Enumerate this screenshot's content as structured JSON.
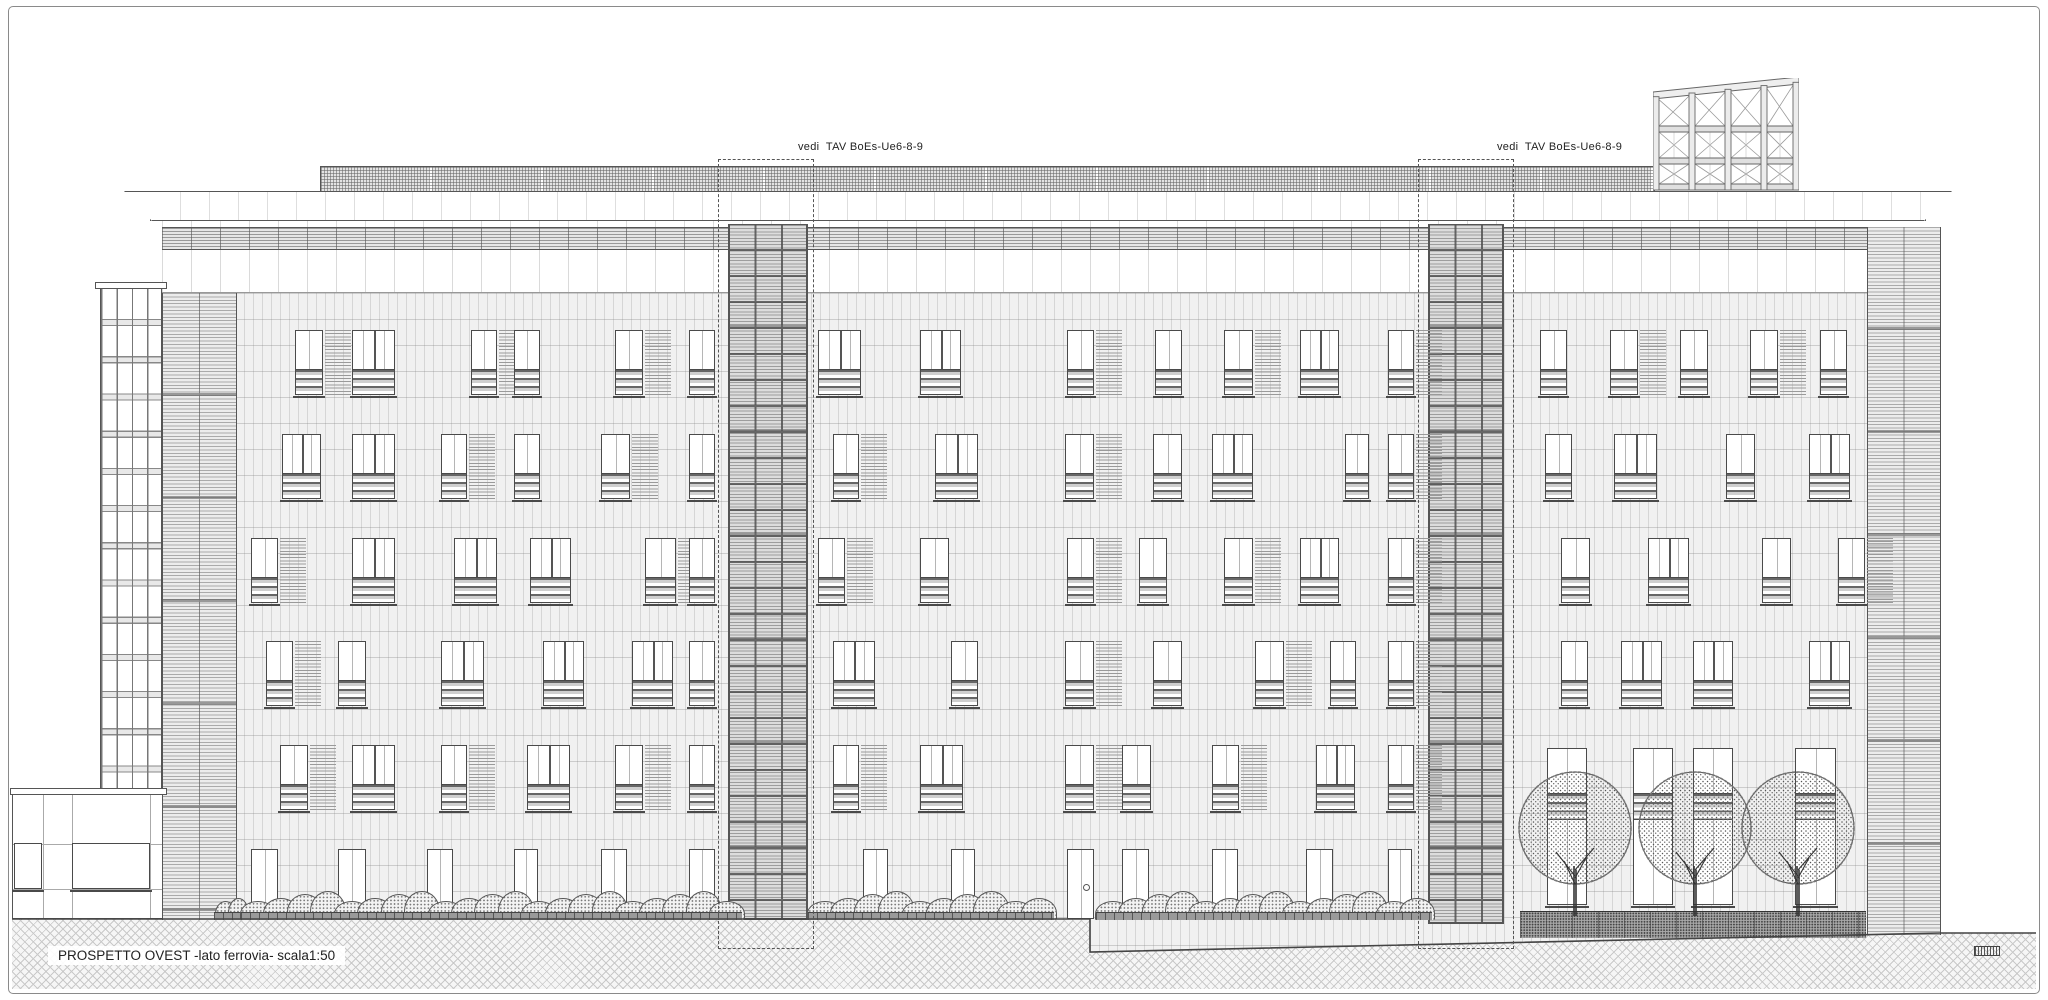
{
  "title": "PROSPETTO OVEST -lato ferrovia- scala1:50",
  "annotations": {
    "detail_ref_left": "vedi  TAV BoEs-Ue6-8-9",
    "detail_ref_right": "vedi  TAV BoEs-Ue6-8-9"
  },
  "colors": {
    "paper": "#ffffff",
    "ink": "#4a4a4a",
    "light_line": "#999999",
    "texture": "#ececec"
  },
  "elevation": {
    "window_rows": [
      {
        "y": 330,
        "h": 65,
        "kind": "std",
        "items": [
          {
            "x": 295,
            "w": 28
          },
          {
            "x": 352,
            "w": 43
          },
          {
            "x": 471,
            "w": 26
          },
          {
            "x": 514,
            "w": 26
          },
          {
            "x": 615,
            "w": 28
          },
          {
            "x": 689,
            "w": 26
          },
          {
            "x": 818,
            "w": 43
          },
          {
            "x": 920,
            "w": 41
          },
          {
            "x": 1067,
            "w": 27
          },
          {
            "x": 1155,
            "w": 27
          },
          {
            "x": 1224,
            "w": 29
          },
          {
            "x": 1300,
            "w": 39
          },
          {
            "x": 1388,
            "w": 26
          },
          {
            "x": 1540,
            "w": 27
          },
          {
            "x": 1610,
            "w": 28
          },
          {
            "x": 1680,
            "w": 28
          },
          {
            "x": 1750,
            "w": 28
          },
          {
            "x": 1820,
            "w": 27
          }
        ]
      },
      {
        "y": 434,
        "h": 65,
        "kind": "std",
        "items": [
          {
            "x": 282,
            "w": 39
          },
          {
            "x": 352,
            "w": 43
          },
          {
            "x": 441,
            "w": 26
          },
          {
            "x": 514,
            "w": 26
          },
          {
            "x": 601,
            "w": 29
          },
          {
            "x": 689,
            "w": 26
          },
          {
            "x": 833,
            "w": 26
          },
          {
            "x": 935,
            "w": 43
          },
          {
            "x": 1065,
            "w": 29
          },
          {
            "x": 1153,
            "w": 29
          },
          {
            "x": 1212,
            "w": 41
          },
          {
            "x": 1345,
            "w": 24
          },
          {
            "x": 1388,
            "w": 26
          },
          {
            "x": 1545,
            "w": 27
          },
          {
            "x": 1614,
            "w": 43
          },
          {
            "x": 1726,
            "w": 29
          },
          {
            "x": 1809,
            "w": 41
          }
        ]
      },
      {
        "y": 538,
        "h": 65,
        "kind": "std",
        "items": [
          {
            "x": 251,
            "w": 27
          },
          {
            "x": 352,
            "w": 43
          },
          {
            "x": 454,
            "w": 43
          },
          {
            "x": 530,
            "w": 41
          },
          {
            "x": 645,
            "w": 31
          },
          {
            "x": 689,
            "w": 26
          },
          {
            "x": 818,
            "w": 27
          },
          {
            "x": 920,
            "w": 29
          },
          {
            "x": 1067,
            "w": 27
          },
          {
            "x": 1139,
            "w": 28
          },
          {
            "x": 1224,
            "w": 29
          },
          {
            "x": 1300,
            "w": 39
          },
          {
            "x": 1388,
            "w": 26
          },
          {
            "x": 1561,
            "w": 29
          },
          {
            "x": 1648,
            "w": 41
          },
          {
            "x": 1762,
            "w": 29
          },
          {
            "x": 1838,
            "w": 27
          }
        ]
      },
      {
        "y": 641,
        "h": 65,
        "kind": "std",
        "items": [
          {
            "x": 266,
            "w": 27
          },
          {
            "x": 338,
            "w": 28
          },
          {
            "x": 441,
            "w": 43
          },
          {
            "x": 543,
            "w": 41
          },
          {
            "x": 632,
            "w": 41
          },
          {
            "x": 689,
            "w": 26
          },
          {
            "x": 833,
            "w": 42
          },
          {
            "x": 951,
            "w": 27
          },
          {
            "x": 1065,
            "w": 29
          },
          {
            "x": 1153,
            "w": 29
          },
          {
            "x": 1255,
            "w": 29
          },
          {
            "x": 1330,
            "w": 26
          },
          {
            "x": 1388,
            "w": 26
          },
          {
            "x": 1561,
            "w": 27
          },
          {
            "x": 1621,
            "w": 41
          },
          {
            "x": 1693,
            "w": 40
          },
          {
            "x": 1809,
            "w": 41
          }
        ]
      },
      {
        "y": 745,
        "h": 65,
        "kind": "std",
        "items": [
          {
            "x": 280,
            "w": 28
          },
          {
            "x": 352,
            "w": 43
          },
          {
            "x": 441,
            "w": 26
          },
          {
            "x": 527,
            "w": 43
          },
          {
            "x": 615,
            "w": 28
          },
          {
            "x": 689,
            "w": 26
          },
          {
            "x": 833,
            "w": 26
          },
          {
            "x": 920,
            "w": 43
          },
          {
            "x": 1065,
            "w": 29
          },
          {
            "x": 1122,
            "w": 29
          },
          {
            "x": 1212,
            "w": 27
          },
          {
            "x": 1316,
            "w": 39
          },
          {
            "x": 1388,
            "w": 26
          }
        ]
      },
      {
        "y": 849,
        "h": 70,
        "kind": "door",
        "items": [
          {
            "x": 251,
            "w": 27
          },
          {
            "x": 338,
            "w": 28
          },
          {
            "x": 427,
            "w": 26
          },
          {
            "x": 514,
            "w": 24
          },
          {
            "x": 601,
            "w": 26
          },
          {
            "x": 689,
            "w": 26
          },
          {
            "x": 863,
            "w": 25
          },
          {
            "x": 951,
            "w": 24
          },
          {
            "x": 1067,
            "w": 27,
            "kind": "glazed-door"
          },
          {
            "x": 1122,
            "w": 27
          },
          {
            "x": 1212,
            "w": 26
          },
          {
            "x": 1306,
            "w": 27
          },
          {
            "x": 1388,
            "w": 24
          }
        ]
      },
      {
        "y": 748,
        "h": 157,
        "kind": "tall",
        "items": [
          {
            "x": 1547,
            "w": 40
          },
          {
            "x": 1633,
            "w": 40
          },
          {
            "x": 1693,
            "w": 40
          },
          {
            "x": 1795,
            "w": 41
          }
        ]
      }
    ],
    "low_building_windows": [
      {
        "x": 14,
        "y": 843,
        "w": 28,
        "h": 46
      },
      {
        "x": 72,
        "y": 843,
        "w": 78,
        "h": 46
      }
    ],
    "towers": [
      {
        "x": 728,
        "w": 80,
        "y": 224,
        "h": 696
      },
      {
        "x": 1428,
        "w": 76,
        "y": 224,
        "h": 700
      }
    ],
    "detail_boxes": [
      {
        "x": 718,
        "y": 159,
        "w": 94,
        "h": 788
      },
      {
        "x": 1418,
        "y": 159,
        "w": 94,
        "h": 788
      }
    ],
    "trees": [
      {
        "cx": 1575
      },
      {
        "cx": 1695
      },
      {
        "cx": 1798
      }
    ],
    "shrub_segments": [
      {
        "x": 218,
        "w": 26
      },
      {
        "x": 245,
        "w": 493
      },
      {
        "x": 812,
        "w": 238
      },
      {
        "x": 1100,
        "w": 328
      }
    ],
    "roof_structure": {
      "x": 1653,
      "y": 78,
      "w": 146,
      "h": 114,
      "cols": 4
    },
    "ground_profile": [
      [
        12,
        919
      ],
      [
        1090,
        919
      ],
      [
        1090,
        952
      ],
      [
        1941,
        933
      ],
      [
        2036,
        933
      ]
    ]
  }
}
